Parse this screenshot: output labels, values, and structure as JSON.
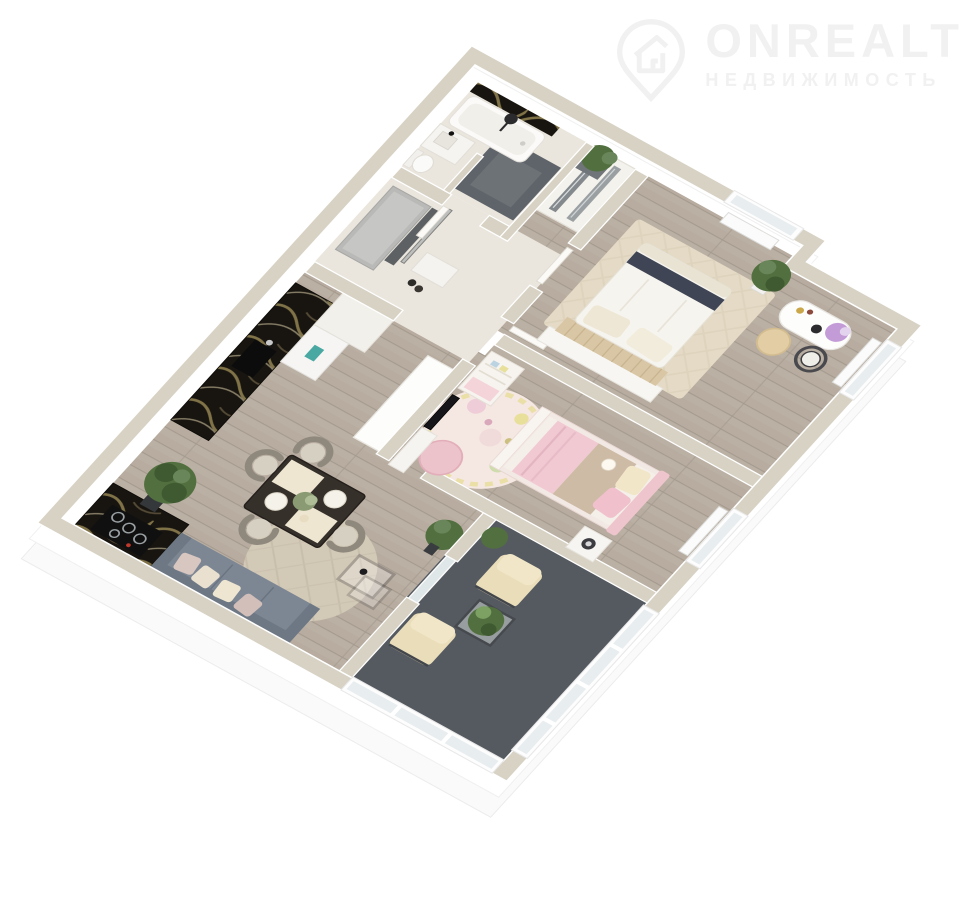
{
  "watermark": {
    "brand": "ONREALT",
    "tagline": "НЕДВИЖИМОСТЬ",
    "icon": "house-pin-icon"
  },
  "scene": {
    "type": "3d-floor-plan-render",
    "rooms": [
      "bathroom",
      "hallway",
      "master-bedroom",
      "kids-bedroom",
      "kitchen-living-room",
      "balcony"
    ]
  },
  "colors": {
    "wm": "#f1f1f1",
    "walltop": "#d7d2c4",
    "wallface": "#ffffff",
    "wood": "#b7ac9f",
    "woodline": "#a49a8d",
    "tile": "#eae6dd",
    "shower": "#5f646a",
    "balconyfloor": "#555a60",
    "marble": "#181510",
    "marblevein": "#8d7d4e",
    "sofa": "#7d8794",
    "sofaback": "#6e7885",
    "rugliving": "#d3c9b7",
    "rugbeige": "#e4dac5",
    "kidsrug": "#f5e7e1",
    "pink": "#f1c9d2",
    "blanket": "#cdbba6",
    "cream": "#f2e6c9",
    "plant": "#52703f",
    "plantdark": "#3f5a31",
    "glass": "#e8edef",
    "graycab": "#b9b9b7",
    "darkpanel": "#5e6164",
    "tv": "#16161a",
    "teal": "#49a8a2",
    "white": "#fbfaf7"
  }
}
